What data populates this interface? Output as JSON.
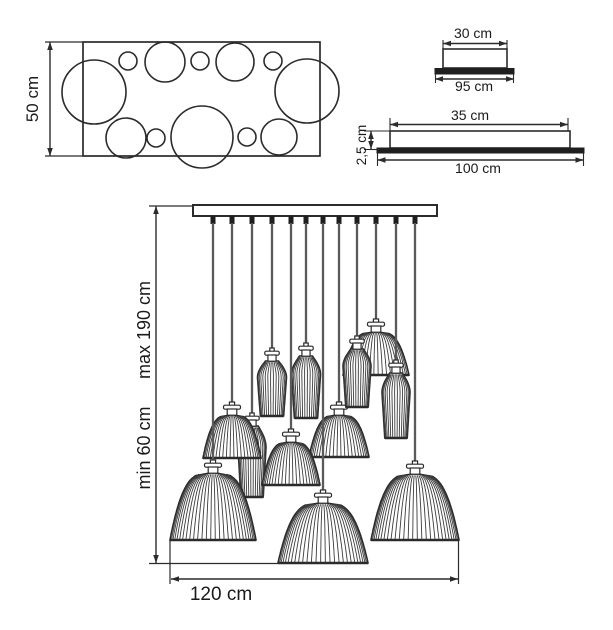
{
  "labels": {
    "top_view_height": "50 cm",
    "canopy_top_width": "30 cm",
    "canopy_top_base": "95 cm",
    "canopy_side_width": "35 cm",
    "canopy_side_height": "2,5 cm",
    "canopy_side_base": "100 cm",
    "drop_max": "max 190 cm",
    "drop_min": "min 60 cm",
    "fixture_width": "120 cm"
  },
  "colors": {
    "line": "#2b2b2b",
    "rib": "#3c3c3c",
    "cord": "#5a5a5c",
    "dark_fill": "#1f1f1f",
    "text": "#1a1a1a",
    "background": "#ffffff"
  },
  "top_view": {
    "rect": {
      "x": 83,
      "y": 42,
      "w": 237,
      "h": 114
    },
    "dim_line": {
      "x": 50,
      "y1": 42,
      "y2": 156
    },
    "circles": [
      {
        "cx": 94,
        "cy": 92,
        "r": 32
      },
      {
        "cx": 128,
        "cy": 61,
        "r": 9
      },
      {
        "cx": 165,
        "cy": 62,
        "r": 20
      },
      {
        "cx": 200,
        "cy": 61,
        "r": 9
      },
      {
        "cx": 235,
        "cy": 62,
        "r": 19
      },
      {
        "cx": 273,
        "cy": 61,
        "r": 9
      },
      {
        "cx": 307,
        "cy": 91,
        "r": 32
      },
      {
        "cx": 126,
        "cy": 138,
        "r": 20
      },
      {
        "cx": 156,
        "cy": 138,
        "r": 9
      },
      {
        "cx": 202,
        "cy": 137,
        "r": 31
      },
      {
        "cx": 247,
        "cy": 137,
        "r": 9
      },
      {
        "cx": 279,
        "cy": 137,
        "r": 18
      }
    ]
  },
  "canopy_front": {
    "box": {
      "x": 443,
      "y": 49,
      "w": 64,
      "h": 19
    },
    "base": {
      "x": 435,
      "y": 68.5,
      "w": 79,
      "h": 5.5
    },
    "dim_top": {
      "y": 43.5,
      "x1": 443,
      "x2": 507
    },
    "dim_bottom": {
      "y": 79,
      "x1": 435,
      "x2": 514
    }
  },
  "canopy_side": {
    "box": {
      "x": 390,
      "y": 131,
      "w": 180,
      "h": 17
    },
    "base": {
      "x": 377,
      "y": 148,
      "w": 207,
      "h": 5
    },
    "dim_top": {
      "y": 124.5,
      "x1": 390,
      "x2": 568
    },
    "dim_bottom": {
      "y": 160,
      "x1": 377.5,
      "x2": 583.5
    },
    "dim_height": {
      "x": 371,
      "y1": 131,
      "y2": 149
    }
  },
  "chandelier": {
    "bar": {
      "x": 193,
      "y": 205,
      "w": 244,
      "h": 11
    },
    "dim_drop": {
      "x": 156,
      "y1": 206,
      "y2": 563
    },
    "dim_width": {
      "y": 579,
      "x1": 171,
      "x2": 458,
      "ext_left_x": 170,
      "ext_right_x": 458.5,
      "ext_y1": 540,
      "ext_y2": 584
    },
    "bottom_ext": {
      "y": 563.5,
      "x1": 149,
      "x2": 278
    },
    "top_ext": {
      "y": 206,
      "x1": 149,
      "x2": 193
    },
    "pendants": [
      {
        "x": 213,
        "type": "dome",
        "neck_y": 460,
        "width": 86,
        "height": 67
      },
      {
        "x": 232,
        "type": "dome",
        "neck_y": 402,
        "width": 58,
        "height": 43
      },
      {
        "x": 252,
        "type": "cone",
        "neck_y": 413,
        "width": 28,
        "height": 71
      },
      {
        "x": 272,
        "type": "cone",
        "neck_y": 348,
        "width": 29,
        "height": 55
      },
      {
        "x": 291,
        "type": "dome",
        "neck_y": 429,
        "width": 58,
        "height": 43
      },
      {
        "x": 306,
        "type": "cone",
        "neck_y": 343,
        "width": 29,
        "height": 62
      },
      {
        "x": 323,
        "type": "dome",
        "neck_y": 490,
        "width": 90,
        "height": 60
      },
      {
        "x": 339,
        "type": "dome",
        "neck_y": 402,
        "width": 60,
        "height": 42
      },
      {
        "x": 357,
        "type": "cone",
        "neck_y": 336,
        "width": 28,
        "height": 58
      },
      {
        "x": 376,
        "type": "dome",
        "neck_y": 319,
        "width": 66,
        "height": 43
      },
      {
        "x": 396,
        "type": "cone",
        "neck_y": 360,
        "width": 28,
        "height": 65
      },
      {
        "x": 415,
        "type": "dome",
        "neck_y": 461,
        "width": 88,
        "height": 66
      }
    ],
    "draw_order": [
      2,
      3,
      5,
      1,
      7,
      4,
      9,
      8,
      10,
      0,
      11,
      6
    ]
  }
}
